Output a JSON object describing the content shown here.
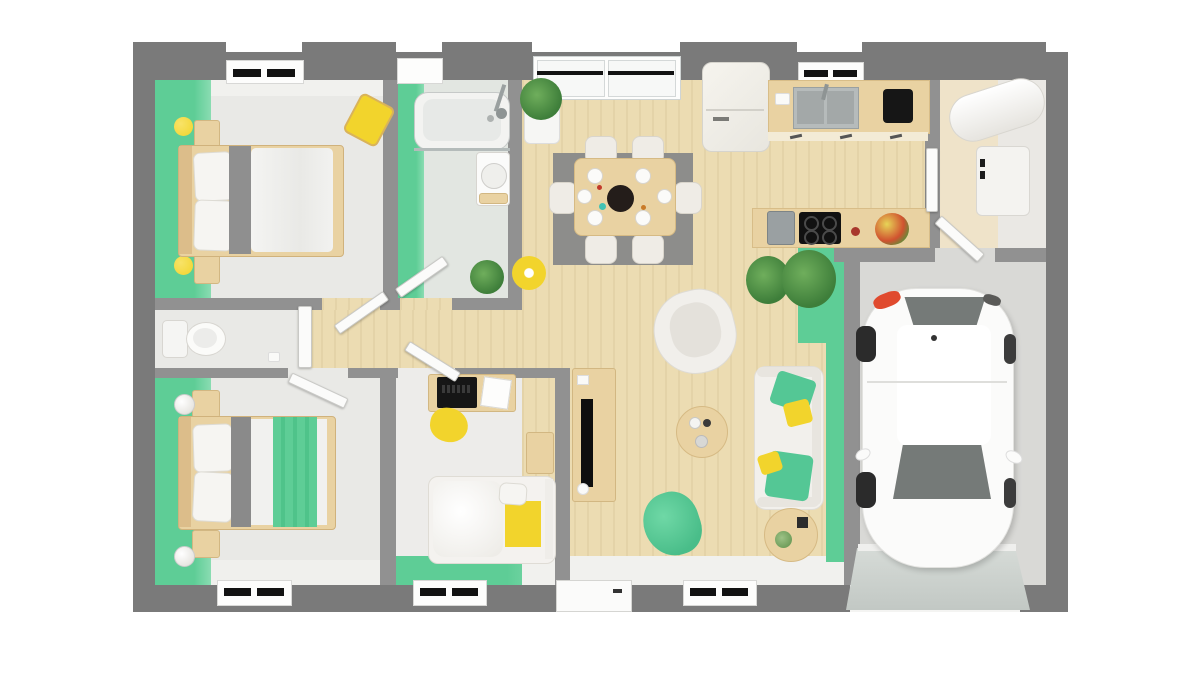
{
  "scene": {
    "description": "3D top-down architectural floor plan rendering of a single-storey house with attached garage",
    "view": "top-down 3D render",
    "visible_text": "none"
  },
  "colors": {
    "outer_wall": "#7a7a7a",
    "inner_wall": "#919191",
    "accent_green": "#5ecd96",
    "accent_green_2": "#8adcb2",
    "wood_floor": "#ecdcb2",
    "wood_furniture": "#e9d2a2",
    "room_floor": "#e9e9e6",
    "bath_floor": "#e2e6e1",
    "garage_floor": "#d9d9d6",
    "rug_gray": "#8d8d8b",
    "accent_yellow": "#f2d42c",
    "fabric_gray": "#8f8f8f",
    "appliance_black": "#161616",
    "car_glass": "#757a78",
    "taillight_red": "#e04a2e",
    "car_body": "#fbfbfa"
  },
  "rooms": [
    {
      "id": "bedroom-1",
      "name": "master bedroom",
      "accent": "green left wall"
    },
    {
      "id": "bathroom",
      "name": "bathroom",
      "accent": "green left wall"
    },
    {
      "id": "wc",
      "name": "separate toilet"
    },
    {
      "id": "bedroom-2",
      "name": "second bedroom",
      "accent": "green left wall"
    },
    {
      "id": "kids-bedroom",
      "name": "kids bedroom",
      "accent": "green bottom wall"
    },
    {
      "id": "hallway",
      "name": "hallway",
      "floor": "wood"
    },
    {
      "id": "living-dining",
      "name": "open living and dining room",
      "floor": "wood",
      "accent": "green garage-side wall"
    },
    {
      "id": "kitchen",
      "name": "open kitchen",
      "floor": "wood"
    },
    {
      "id": "utility",
      "name": "utility room with water heater"
    },
    {
      "id": "garage",
      "name": "garage with white car"
    }
  ],
  "furniture": {
    "bedroom_1": [
      "double bed with white duvet and gray runner",
      "two wooden nightstands",
      "two yellow ball lamps",
      "yellow bench"
    ],
    "bathroom": [
      "bathtub with glass screen",
      "shower fixture",
      "washbasin on wooden cabinet",
      "potted plant"
    ],
    "wc": [
      "toilet"
    ],
    "bedroom_2": [
      "double bed with green blanket",
      "two wooden nightstands",
      "two white ball lamps"
    ],
    "kids_bedroom": [
      "desk with black laptop and papers",
      "yellow rug",
      "single bed with yellow blanket",
      "wooden nightstand"
    ],
    "living_dining": [
      "dining table with six white chairs and place settings",
      "gray rug",
      "tall potted plant",
      "yellow pendant lamp",
      "white armchair",
      "white sofa with green and yellow cushions",
      "round wooden coffee table",
      "round wooden side table",
      "green pouf",
      "TV sideboard with flat TV",
      "two green plants"
    ],
    "kitchen": [
      "fridge",
      "counter with double sink and faucet",
      "black coffee machine",
      "island counter",
      "black cooktop with four burners",
      "gray coffee maker",
      "fruit bowl"
    ],
    "utility": [
      "horizontal water heater cylinder",
      "washing machine"
    ],
    "garage": [
      "white hatchback car",
      "garage door ramp"
    ]
  },
  "openings": {
    "windows_top": [
      "bedroom-1 window",
      "bathroom window",
      "dining glass doors",
      "kitchen window"
    ],
    "windows_bottom": [
      "bedroom-2 window",
      "kids-bedroom window",
      "living-room window"
    ],
    "doors": [
      "bathroom door",
      "bedroom-1 door",
      "wc door",
      "bedroom-2 door",
      "kids-bedroom door",
      "entry door",
      "kitchen-utility door",
      "utility-garage door",
      "garage door"
    ]
  }
}
